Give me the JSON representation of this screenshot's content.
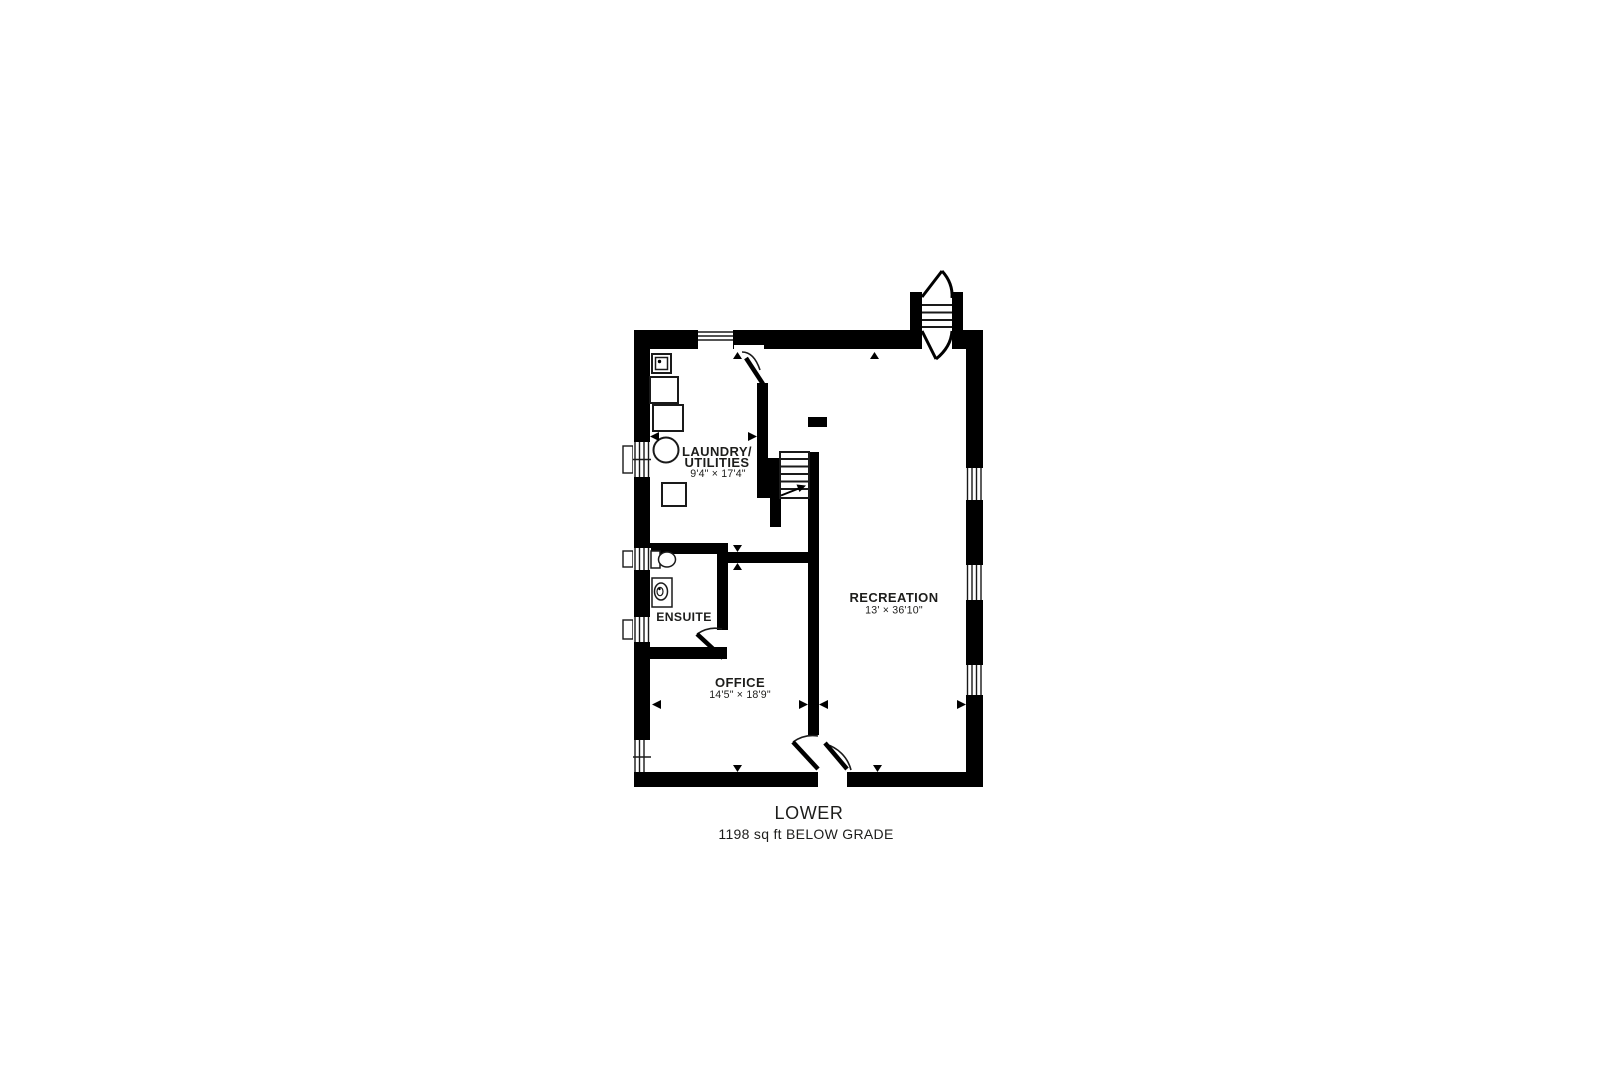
{
  "canvas": {
    "background": "#ffffff",
    "ink": "#000000",
    "label_color": "#1d1d1b"
  },
  "floor_plan": {
    "rooms": {
      "laundry": {
        "name_line1": "LAUNDRY/",
        "name_line2": "UTILITIES",
        "dimensions": "9'4\" × 17'4\""
      },
      "ensuite": {
        "name": "ENSUITE"
      },
      "office": {
        "name": "OFFICE",
        "dimensions": "14'5\" × 18'9\""
      },
      "recreation": {
        "name": "RECREATION",
        "dimensions": "13' × 36'10\""
      }
    },
    "footer": {
      "level_name": "LOWER",
      "area_note": "1198 sq ft BELOW GRADE"
    },
    "icons": {
      "washer": "outlined square",
      "dryer": "outlined square",
      "laundry_tub": "small square with faucet dot",
      "water_heater": "outlined circle",
      "furnace": "outlined square",
      "toilet": "tank rectangle with bowl ellipse",
      "vanity_sink": "rectangle with oval basin",
      "interior_stairs": "treads with up arrow",
      "exterior_stairwell": "treads with curved break lines",
      "window": "white wall break with pane lines",
      "door_swing": "thick leaf line with quarter arc",
      "dimension_marker": "small solid triangle"
    }
  }
}
